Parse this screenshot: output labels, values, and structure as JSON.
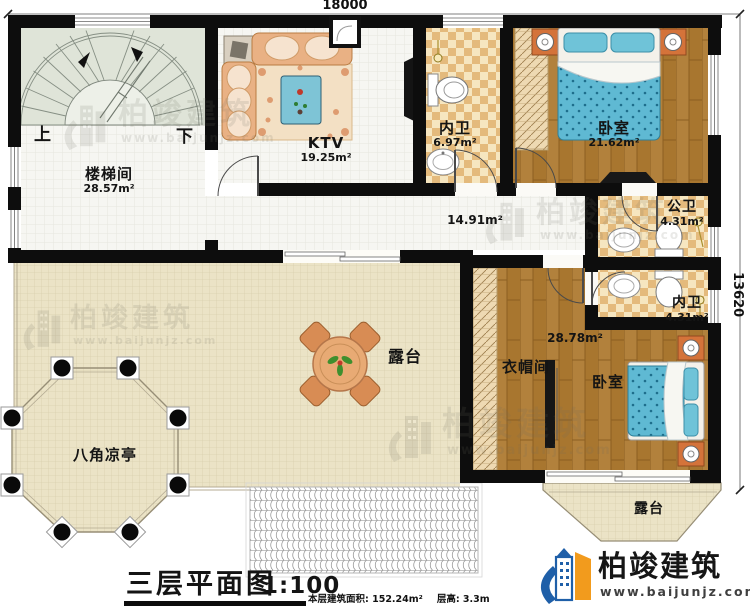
{
  "title_block": {
    "title": "三层平面图",
    "scale": "1:100",
    "area_note": "本层建筑面积: 152.24m²",
    "height_note": "层高: 3.3m"
  },
  "dimensions": {
    "top": "18000",
    "right": "13620"
  },
  "rooms": {
    "stairwell": {
      "name": "楼梯间",
      "area": "28.57m²",
      "up": "上",
      "down": "下"
    },
    "ktv": {
      "name": "KTV",
      "area": "19.25m²"
    },
    "bath_top": {
      "name": "内卫",
      "area": "6.97m²"
    },
    "bedroom1": {
      "name": "卧室",
      "area": "21.62m²"
    },
    "public_bath": {
      "name": "公卫",
      "area": "4.31m²"
    },
    "bath_mid": {
      "name": "内卫",
      "area": "4.31m²"
    },
    "corridor": {
      "area": "14.91m²"
    },
    "bedroom2": {
      "name": "卧室",
      "area": "28.78m²"
    },
    "cloakroom": {
      "name": "衣帽间"
    },
    "terrace_main": {
      "name": "露台"
    },
    "terrace_small": {
      "name": "露台"
    },
    "pavilion": {
      "name": "八角凉亭"
    }
  },
  "brand": {
    "name": "柏竣建筑",
    "url": "www.baijunjz.com"
  },
  "watermark": {
    "text": "柏竣建筑",
    "url": "www.baijunjz.com"
  },
  "colors": {
    "wall": "#0d0d0d",
    "wood_floor": "#a8762f",
    "bath_tile": "#e4ba7c",
    "terrace": "#ebe3c6",
    "stair_area": "#dfe4d8",
    "bed_fabric": "#5fb9d3",
    "furniture": "#e8aa74",
    "logo_blue": "#1f5fa8",
    "logo_orange": "#f29b1d"
  }
}
